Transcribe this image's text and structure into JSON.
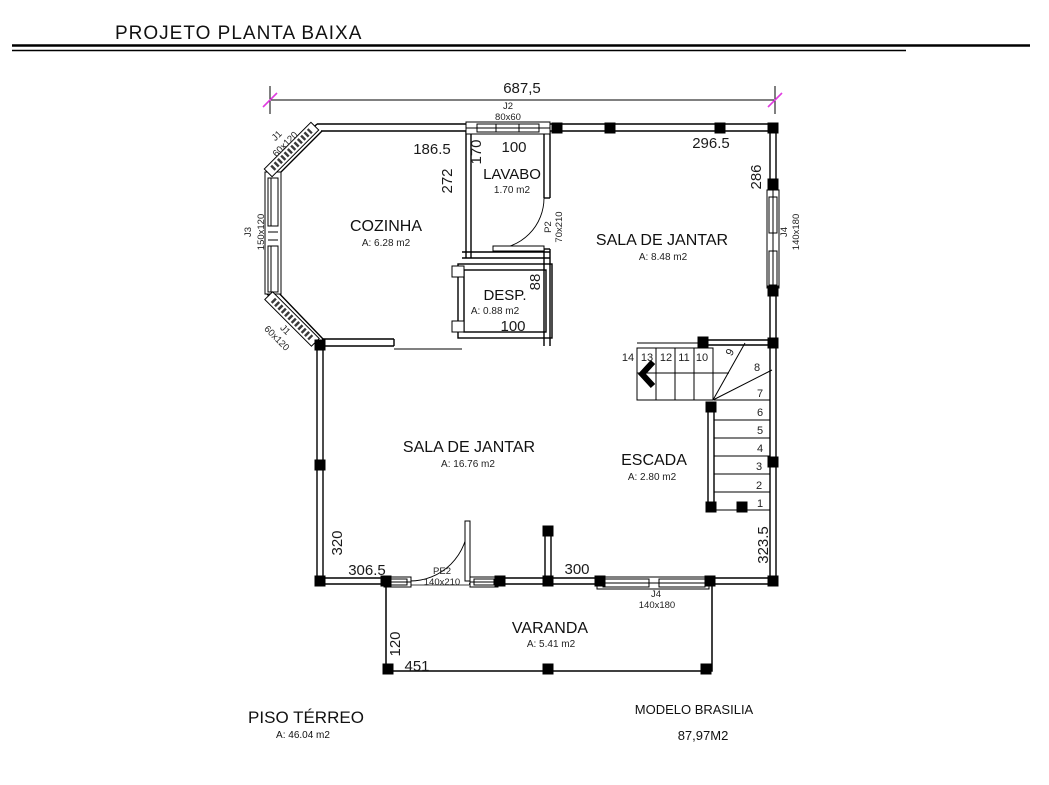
{
  "page": {
    "title": "PROJETO PLANTA BAIXA"
  },
  "plan": {
    "overall_width_dim": "687,5",
    "rooms": {
      "cozinha": {
        "name": "COZINHA",
        "area": "A: 6.28 m2",
        "width_dim": "186.5",
        "height_dim": "272"
      },
      "lavabo": {
        "name": "LAVABO",
        "area": "1.70 m2",
        "width_dim": "100",
        "height_dim": "170"
      },
      "despensa": {
        "name": "DESP.",
        "area": "A: 0.88 m2",
        "width_dim": "100",
        "height_dim": "88"
      },
      "sala_jantar_superior": {
        "name": "SALA DE JANTAR",
        "area": "A: 8.48 m2",
        "width_dim": "296.5",
        "height_dim": "286"
      },
      "sala_jantar_inferior": {
        "name": "SALA DE JANTAR",
        "area": "A: 16.76 m2",
        "width_dim": "306.5",
        "height_dim": "320"
      },
      "escada": {
        "name": "ESCADA",
        "area": "A: 2.80 m2",
        "bottom_dim": "300",
        "right_height_dim": "323.5"
      },
      "varanda": {
        "name": "VARANDA",
        "area": "A: 5.41 m2",
        "width_dim": "451",
        "height_dim": "120"
      }
    },
    "openings": {
      "j1_top": {
        "code": "J1",
        "size": "60x120"
      },
      "j1_bottom": {
        "code": "J1",
        "size": "60x120"
      },
      "j2": {
        "code": "J2",
        "size": "80x60"
      },
      "j3": {
        "code": "J3",
        "size": "150x120"
      },
      "j4_right": {
        "code": "J4",
        "size": "140x180"
      },
      "j4_bottom": {
        "code": "J4",
        "size": "140x180"
      },
      "p2": {
        "code": "P2",
        "size": "70x210"
      },
      "pe2": {
        "code": "PE2",
        "size": "140x210"
      }
    },
    "stairs": {
      "steps": [
        "14",
        "13",
        "12",
        "11",
        "10",
        "9",
        "8",
        "7",
        "6",
        "5",
        "4",
        "3",
        "2",
        "1"
      ]
    }
  },
  "footer": {
    "floor_label": "PISO TÉRREO",
    "floor_area": "A: 46.04 m2",
    "model_label": "MODELO BRASILIA",
    "model_area": "87,97M2"
  },
  "colors": {
    "ink": "#000000",
    "dim_tick": "#e03ce0"
  }
}
